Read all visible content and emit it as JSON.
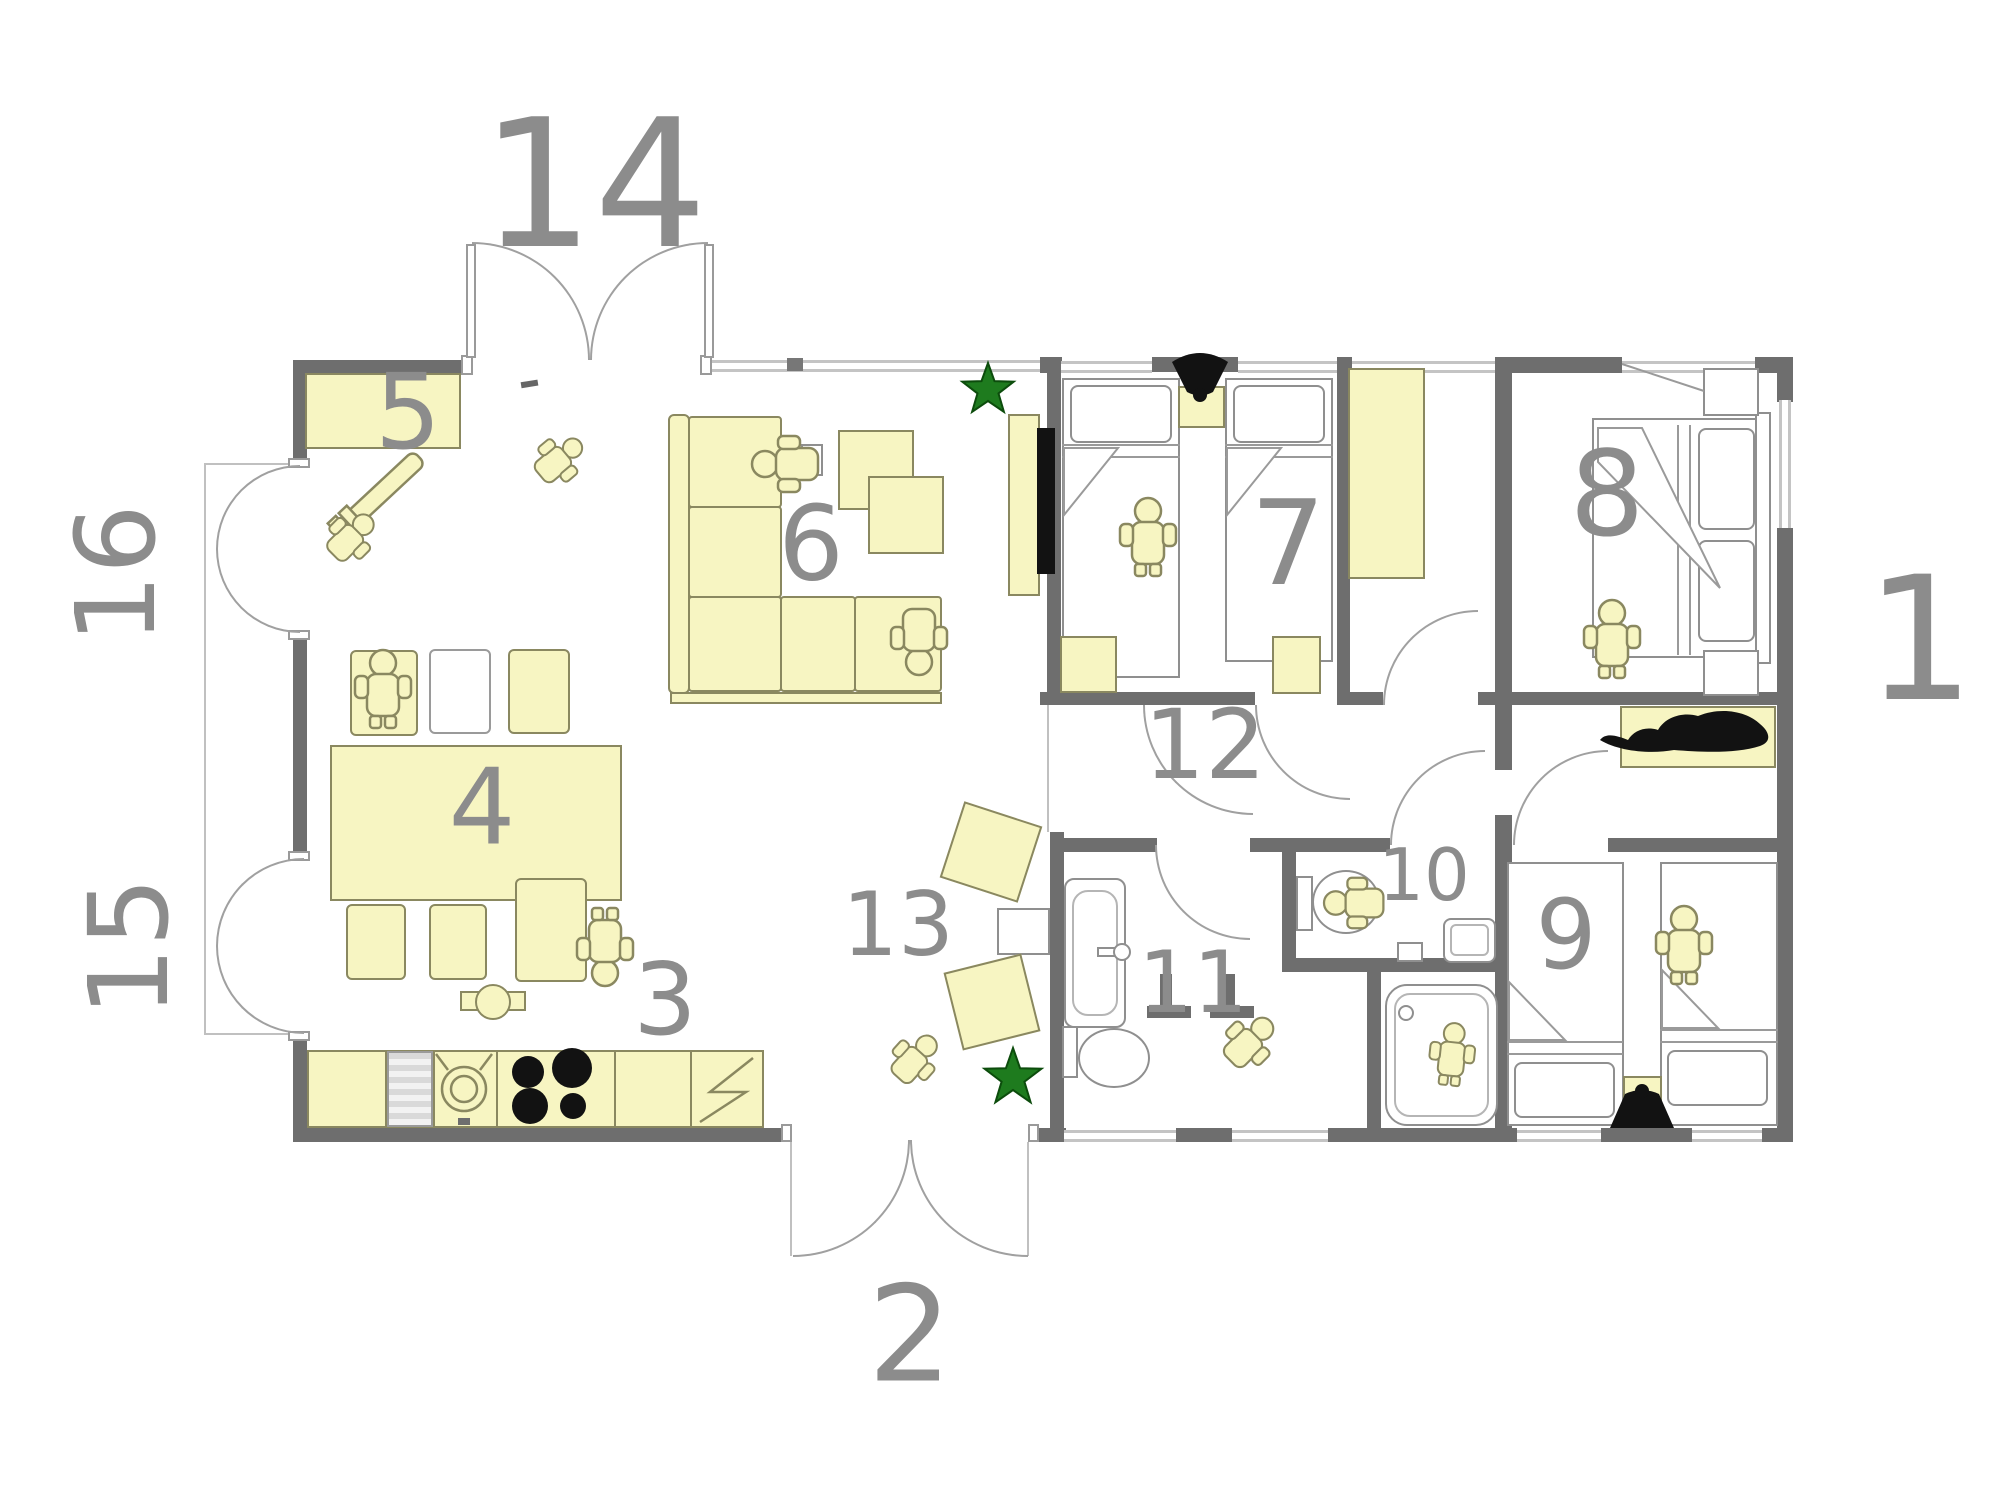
{
  "colors": {
    "wall": "#6e6e6e",
    "furniture-fill": "#f7f5c2",
    "furniture-border": "#8a8860",
    "white-fixture": "#ffffff",
    "fixture-border": "#8f8f8f",
    "label": "#8c8c8c",
    "window": "#c4c4c4",
    "arc": "#a0a0a0",
    "thin-line": "#c0c0c0",
    "plant-green": "#1e7b1e",
    "black-item": "#121212",
    "background": "#ffffff"
  },
  "labels": {
    "l1": "1",
    "l2": "2",
    "l3": "3",
    "l4": "4",
    "l5": "5",
    "l6": "6",
    "l7": "7",
    "l8": "8",
    "l9": "9",
    "l10": "10",
    "l11": "11",
    "l12": "12",
    "l13": "13",
    "l14": "14",
    "l15": "15",
    "l16": "16"
  },
  "icons": {
    "plant_star": "★",
    "cat": "cat-silhouette",
    "person": "person-top-view"
  }
}
